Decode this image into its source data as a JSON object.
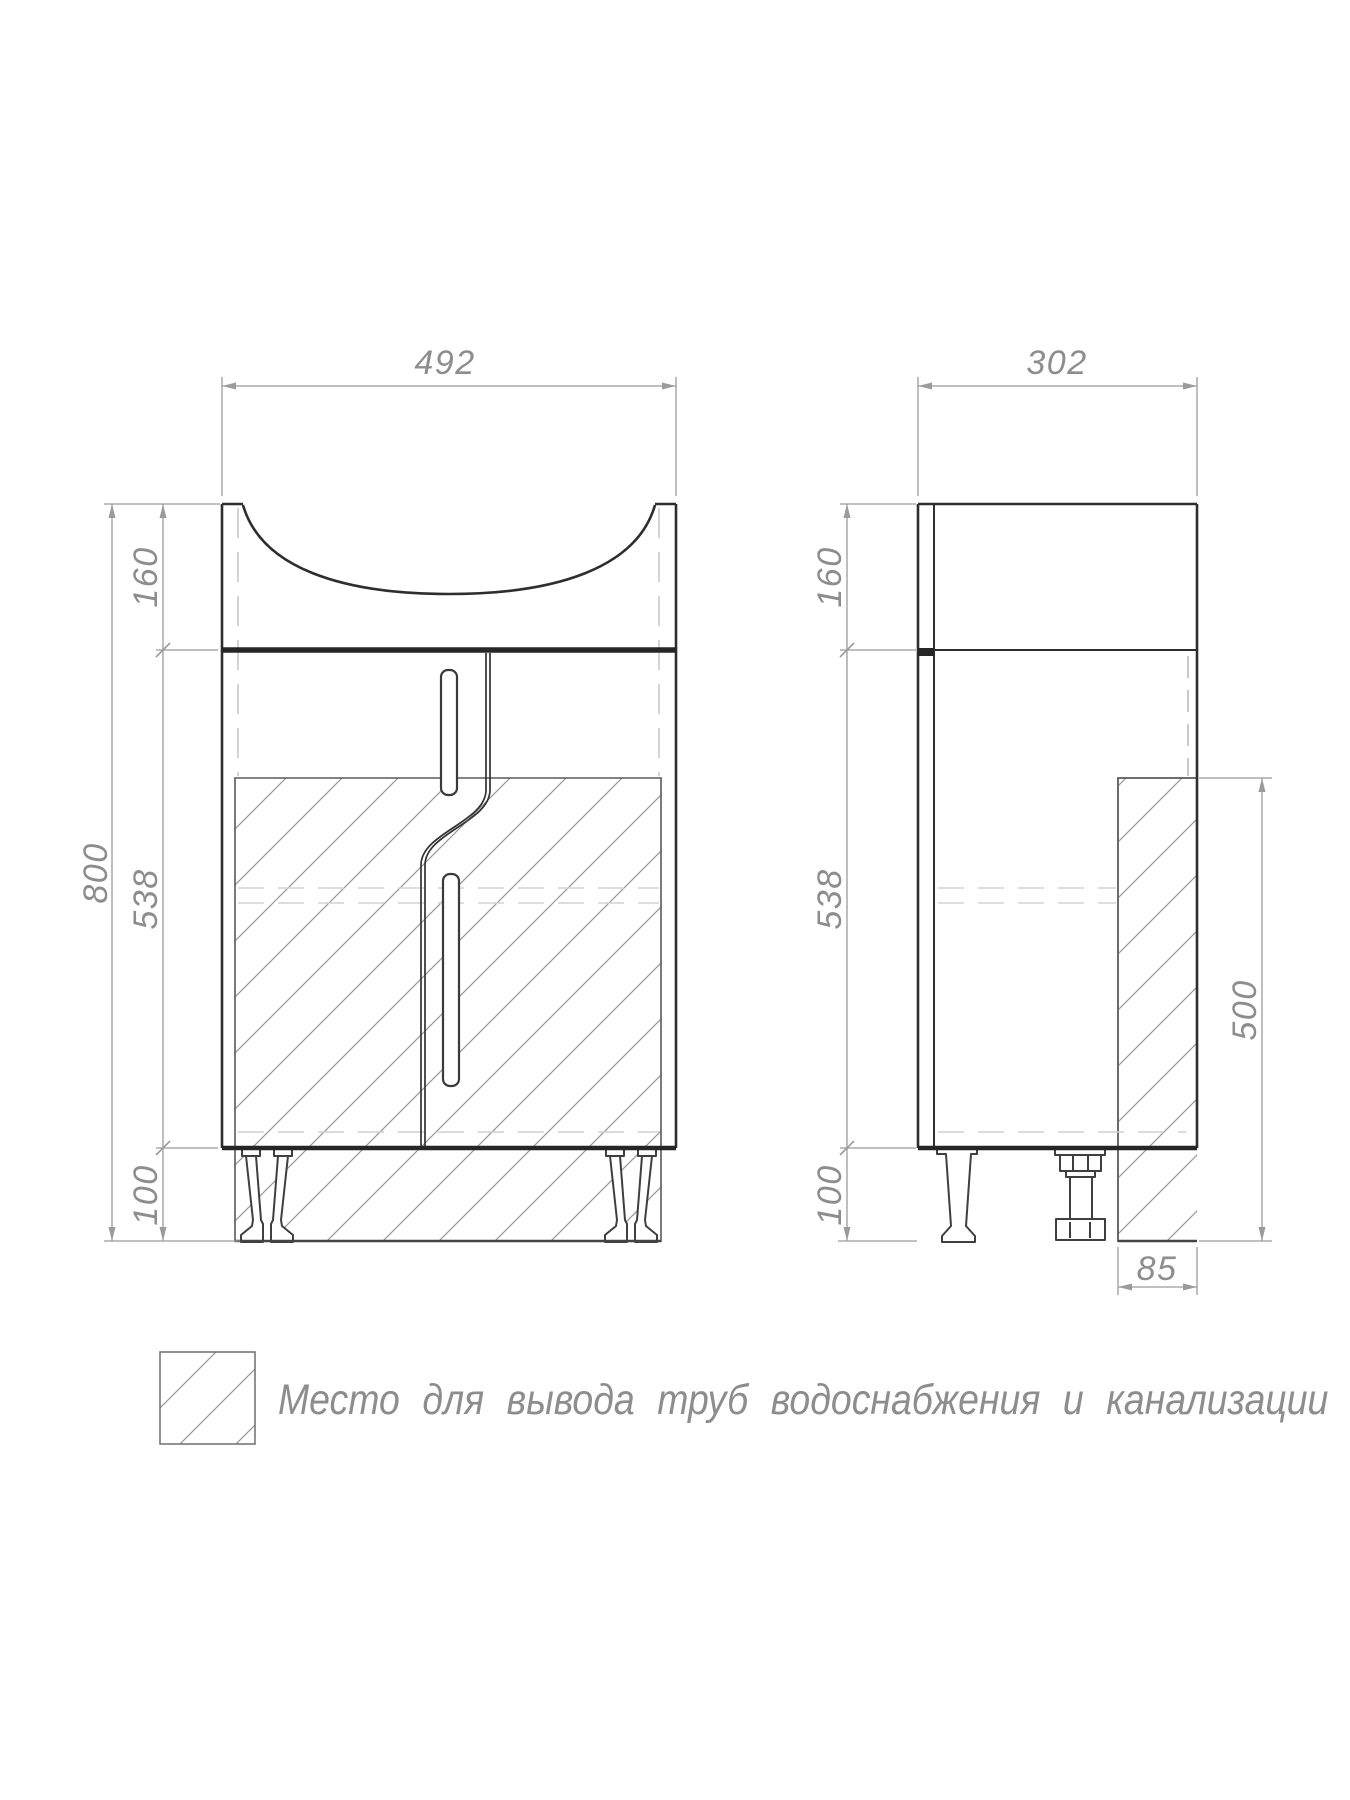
{
  "drawing": {
    "kind": "vanity-cabinet-technical-drawing",
    "views": {
      "front": {
        "width": "492",
        "total_height": "800",
        "top_section_height": "160",
        "body_height": "538",
        "legs_height": "100"
      },
      "side": {
        "depth": "302",
        "top_section_height": "160",
        "body_height": "538",
        "legs_height": "100",
        "pipe_zone_height": "500",
        "pipe_zone_depth": "85"
      }
    },
    "legend": {
      "symbol": "hatched-square",
      "text": "Место для вывода труб водоснабжения и канализации"
    },
    "colors": {
      "outline": "#2e2e2e",
      "dimension_line": "#9b9b9b",
      "dimension_text": "#8d8d8d",
      "hatch": "#9a9a9a",
      "hidden_line": "#c9c9c9",
      "background": "#ffffff"
    }
  }
}
